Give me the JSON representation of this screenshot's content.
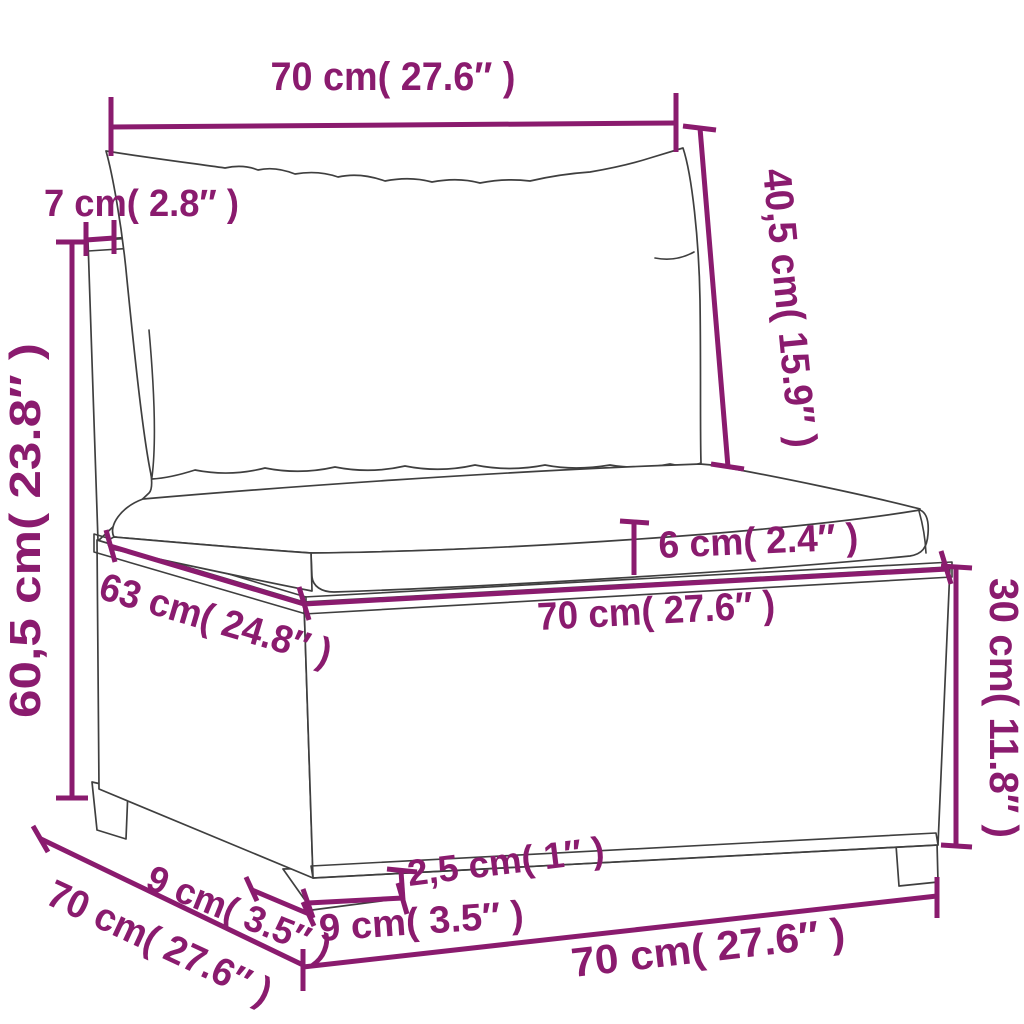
{
  "figure": {
    "type": "product-dimension-diagram",
    "subject": "poly-rattan garden sofa middle section with back and seat cushions",
    "colors": {
      "dimension_lines": "#8a1b6e",
      "line_art": "#3f3f3f",
      "background": "#ffffff"
    },
    "dimensions": {
      "back_cushion_width": "70 cm( 27.6″ )",
      "back_cushion_height": "40,5 cm( 15.9″ )",
      "back_panel_thickness": "7 cm( 2.8″ )",
      "total_height": "60,5 cm( 23.8″ )",
      "seat_cushion_thickness": "6 cm( 2.4″ )",
      "seat_depth": "63 cm( 24.8″ )",
      "seat_width": "70 cm( 27.6″ )",
      "base_height": "30 cm( 11.8″ )",
      "leg_height": "2,5 cm( 1″ )",
      "leg_front_width": "9 cm( 3.5″ )",
      "leg_side_depth": "9 cm( 3.5″ )",
      "overall_depth": "70 cm( 27.6″ )",
      "overall_width": "70 cm( 27.6″ )"
    }
  }
}
